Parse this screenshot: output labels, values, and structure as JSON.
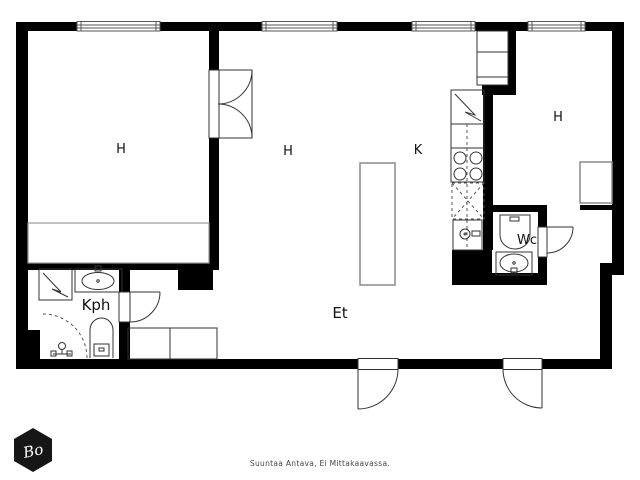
{
  "plan": {
    "labels": {
      "h1": "H",
      "h2": "H",
      "k": "K",
      "h3": "H",
      "wc": "Wc",
      "kph": "Kph",
      "et": "Et"
    }
  },
  "footer": {
    "disclaimer": "Suuntaa Antava, Ei Mittakaavassa."
  },
  "logo": {
    "monogram": "Bo"
  },
  "colors": {
    "wall": "#000000",
    "line": "#333333",
    "furniture": "#999999",
    "background": "#ffffff"
  }
}
